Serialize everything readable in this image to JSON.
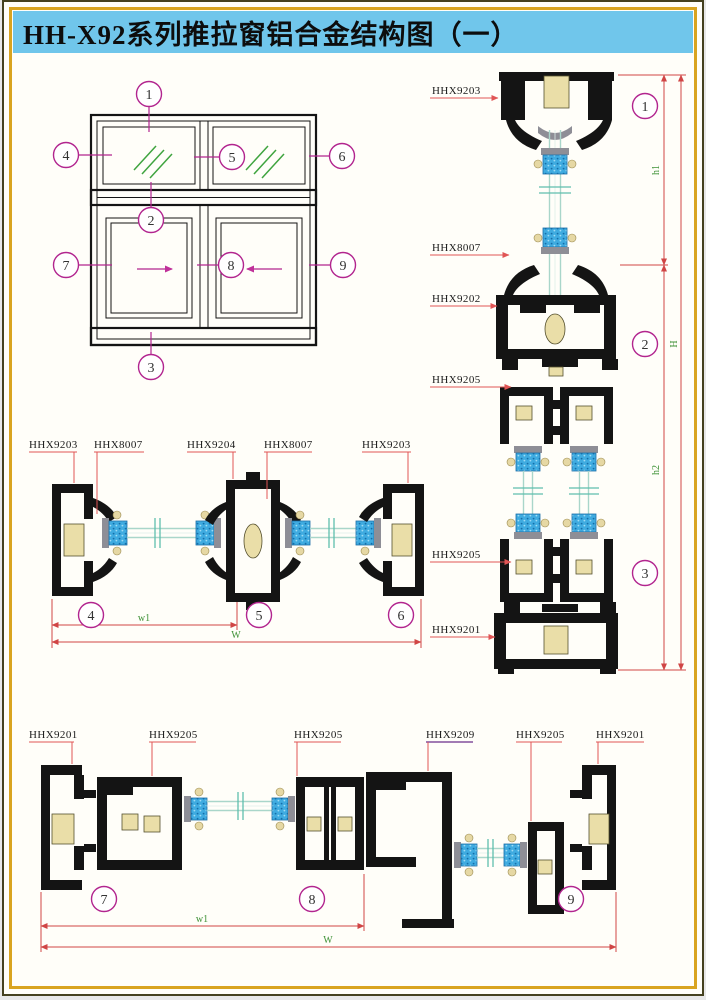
{
  "title": "HH-X92系列推拉窗铝合金结构图（一）",
  "colors": {
    "title_bar_bg": "#70C6EB",
    "border_gold": "#D9A420",
    "border_dark": "#45411F",
    "callout_magenta": "#B2258F",
    "leader_red": "#E05555",
    "leader_purple": "#6B2D8B",
    "dim_crimson": "#D04545",
    "dim_text_green": "#3F9237",
    "glass_teal": "#5FBFAE",
    "glass_line": "#A9D6CA",
    "glazing_blue": "#3FABE0",
    "thermal_tan": "#EADEA8",
    "gasket_gray": "#8E8E96",
    "drawing_black": "#141414",
    "hatch_green": "#3FA43F"
  },
  "elevation": {
    "callouts": [
      "1",
      "2",
      "3",
      "4",
      "5",
      "6",
      "7",
      "8",
      "9"
    ]
  },
  "vertical_section": {
    "labels": [
      "HHX9203",
      "HHX8007",
      "HHX9202",
      "HHX9205",
      "HHX9205",
      "HHX9201"
    ],
    "callouts": [
      "1",
      "2",
      "3"
    ],
    "dims": {
      "h1": "h1",
      "h2": "h2",
      "H": "H"
    }
  },
  "top_section": {
    "labels": [
      "HHX9203",
      "HHX8007",
      "HHX9204",
      "HHX8007",
      "HHX9203"
    ],
    "callouts": [
      "4",
      "5",
      "6"
    ],
    "dims": {
      "w1": "w1",
      "W": "W"
    }
  },
  "bottom_section": {
    "labels": [
      "HHX9201",
      "HHX9205",
      "HHX9205",
      "HHX9209",
      "HHX9205",
      "HHX9201"
    ],
    "callouts": [
      "7",
      "8",
      "9"
    ],
    "dims": {
      "w1": "w1",
      "W": "W"
    }
  }
}
